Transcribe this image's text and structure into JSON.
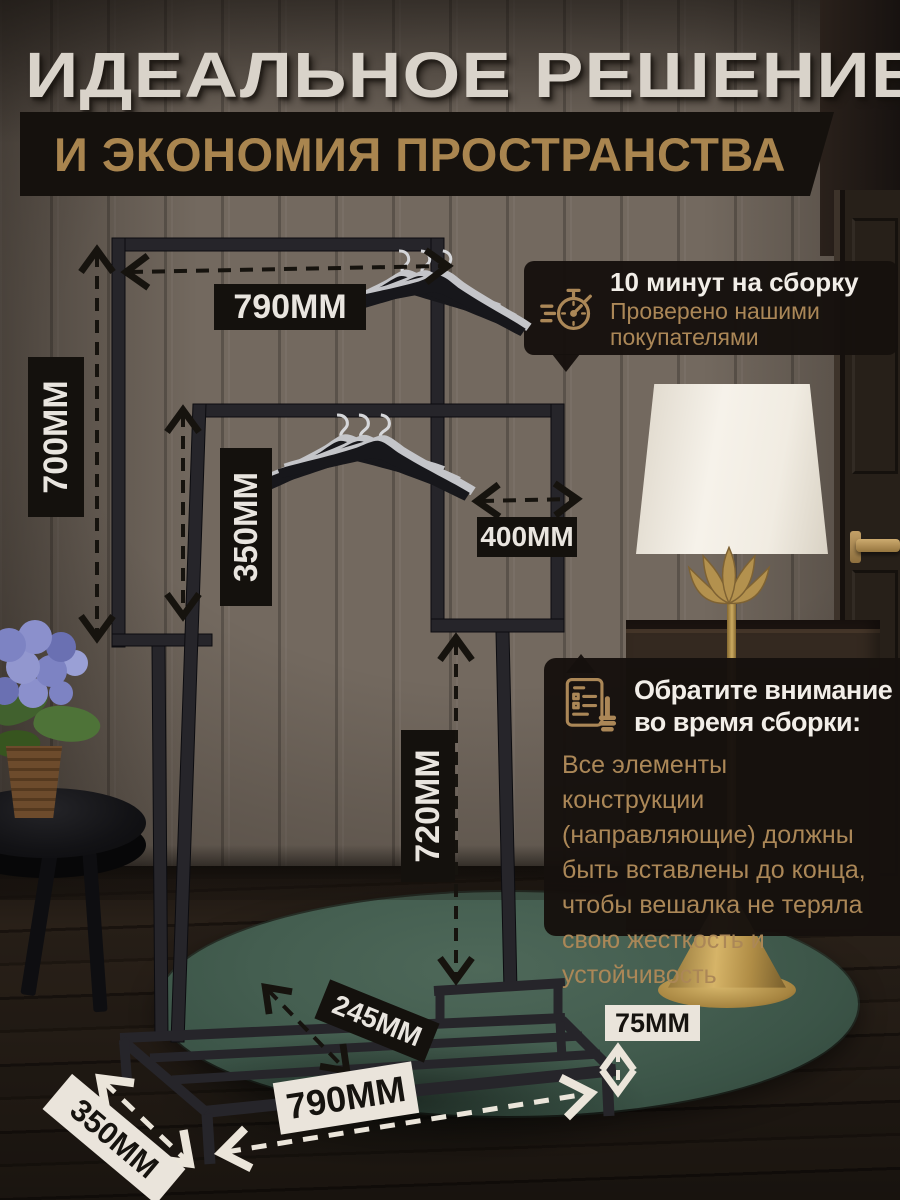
{
  "header": {
    "title": "ИДЕАЛЬНОЕ РЕШЕНИЕ",
    "subtitle": "И ЭКОНОМИЯ ПРОСТРАНСТВА"
  },
  "assembly_badge": {
    "icon": "stopwatch-icon",
    "title": "10 минут на сборку",
    "subtitle_lines": [
      "Проверено нашими",
      "покупателями"
    ]
  },
  "note_card": {
    "icon": "checklist-hand-icon",
    "title_lines": [
      "Обратите внимание",
      "во время сборки:"
    ],
    "body_lines": [
      "Все элементы",
      "конструкции",
      "(направляющие) должны",
      "быть вставлены до конца,",
      "чтобы вешалка не теряла",
      "свою жесткость и",
      "устойчивость"
    ]
  },
  "dimensions": {
    "top_width": "790MM",
    "left_height": "700MM",
    "rail_height": "350MM",
    "inner_width": "400MM",
    "pole_height": "720MM",
    "base_inner_depth": "245MM",
    "base_height": "75MM",
    "base_width": "790MM",
    "base_depth": "350MM"
  },
  "colors": {
    "accent_gold": "#ab8757",
    "label_dark_bg": "#14110d",
    "label_light_bg": "#eae4db",
    "headline_text": "#d9d3ca",
    "rug_green": "#425c4e",
    "rack_metal": "#26252a"
  }
}
